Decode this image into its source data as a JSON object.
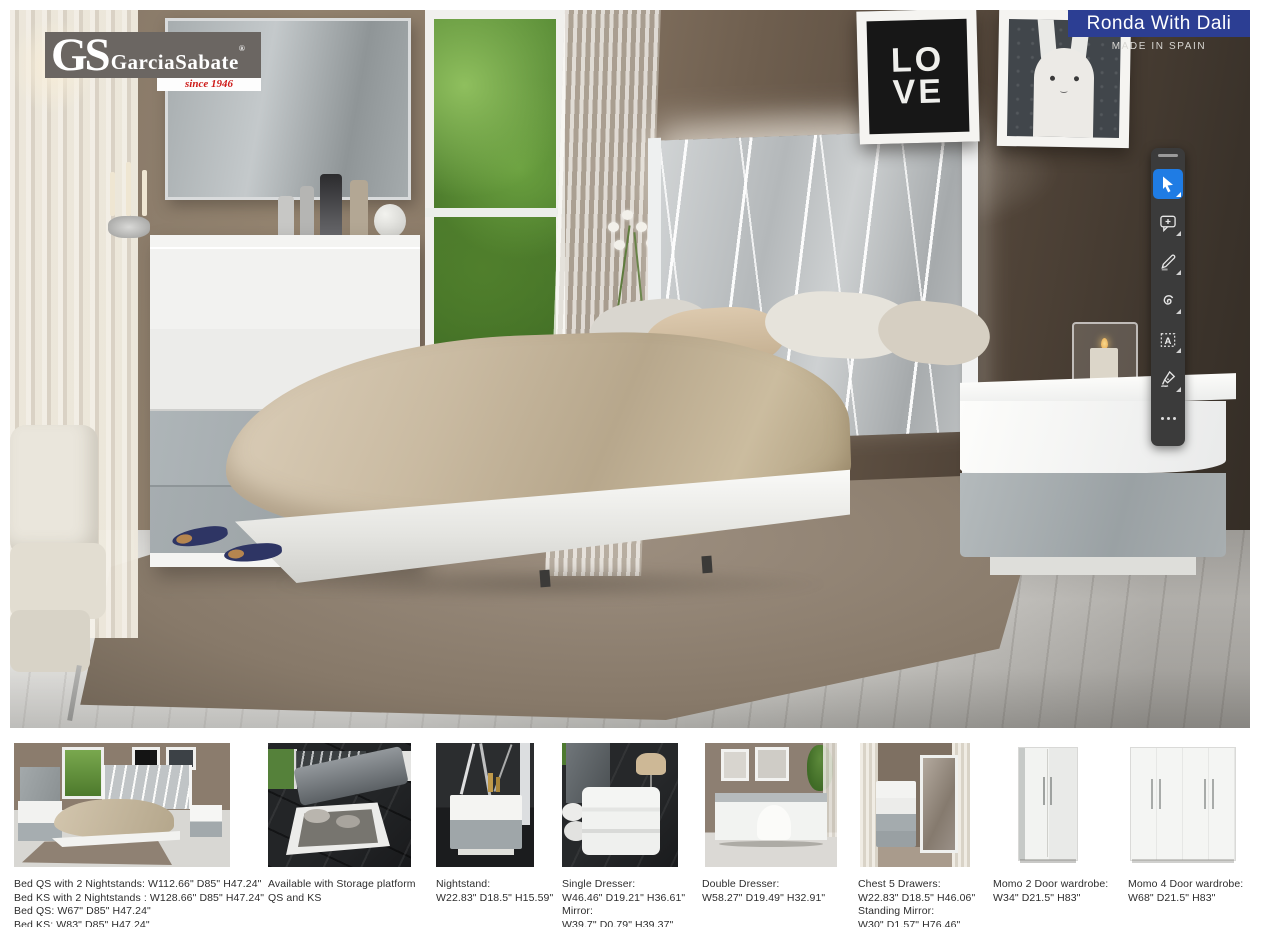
{
  "header": {
    "logo": {
      "monogram": "GS",
      "name": "GarciaSabate",
      "registered": "®",
      "tagline": "since 1946",
      "colors": {
        "box_gray": "#6b6662",
        "tagline_red": "#ce1a18"
      }
    },
    "banner": {
      "title": "Ronda With Dali",
      "subtitle": "MADE IN SPAIN",
      "color": "#2c3e93"
    }
  },
  "scene": {
    "love_poster": {
      "line1": "LO",
      "line2": "VE"
    }
  },
  "toolbar": {
    "background": "#3b3b3b",
    "active_color": "#1f7ce4",
    "tools": [
      {
        "name": "select-tool",
        "icon": "cursor-arrow-icon",
        "active": true
      },
      {
        "name": "add-comment-tool",
        "icon": "comment-plus-icon",
        "active": false
      },
      {
        "name": "pen-tool",
        "icon": "pencil-icon",
        "active": false
      },
      {
        "name": "curve-tool",
        "icon": "curve-scribble-icon",
        "active": false
      },
      {
        "name": "text-box-tool",
        "icon": "text-box-icon",
        "active": false
      },
      {
        "name": "ink-signature-tool",
        "icon": "ink-pen-icon",
        "active": false
      },
      {
        "name": "more-tools",
        "icon": "ellipsis-icon",
        "active": false
      }
    ]
  },
  "products": [
    {
      "name": "bed-with-nightstands",
      "lines": [
        "Bed QS with 2 Nightstands: W112.66\" D85\" H47.24\"",
        "Bed KS with 2 Nightstands : W128.66\" D85\" H47.24\"",
        "Bed QS: W67\" D85\" H47.24\"",
        "Bed KS: W83\" D85\" H47.24\""
      ]
    },
    {
      "name": "storage-platform",
      "lines": [
        "Available with Storage platform",
        "QS and KS"
      ]
    },
    {
      "name": "nightstand",
      "lines": [
        "Nightstand:",
        "W22.83\" D18.5\" H15.59\""
      ]
    },
    {
      "name": "single-dresser",
      "lines": [
        "Single Dresser:",
        "W46.46\" D19.21\" H36.61\"",
        "Mirror:",
        "W39.7\" D0.79\" H39.37\""
      ]
    },
    {
      "name": "double-dresser",
      "lines": [
        "Double Dresser:",
        "W58.27\" D19.49\" H32.91\""
      ]
    },
    {
      "name": "chest-5-drawers",
      "lines": [
        "Chest 5 Drawers:",
        "W22.83\" D18.5\" H46.06\"",
        "Standing Mirror:",
        "W30\" D1.57\" H76.46\""
      ]
    },
    {
      "name": "momo-2-door-wardrobe",
      "lines": [
        "Momo 2 Door wardrobe:",
        "W34\" D21.5\" H83\""
      ]
    },
    {
      "name": "momo-4-door-wardrobe",
      "lines": [
        "Momo 4 Door wardrobe:",
        "W68\" D21.5\" H83\""
      ]
    }
  ]
}
